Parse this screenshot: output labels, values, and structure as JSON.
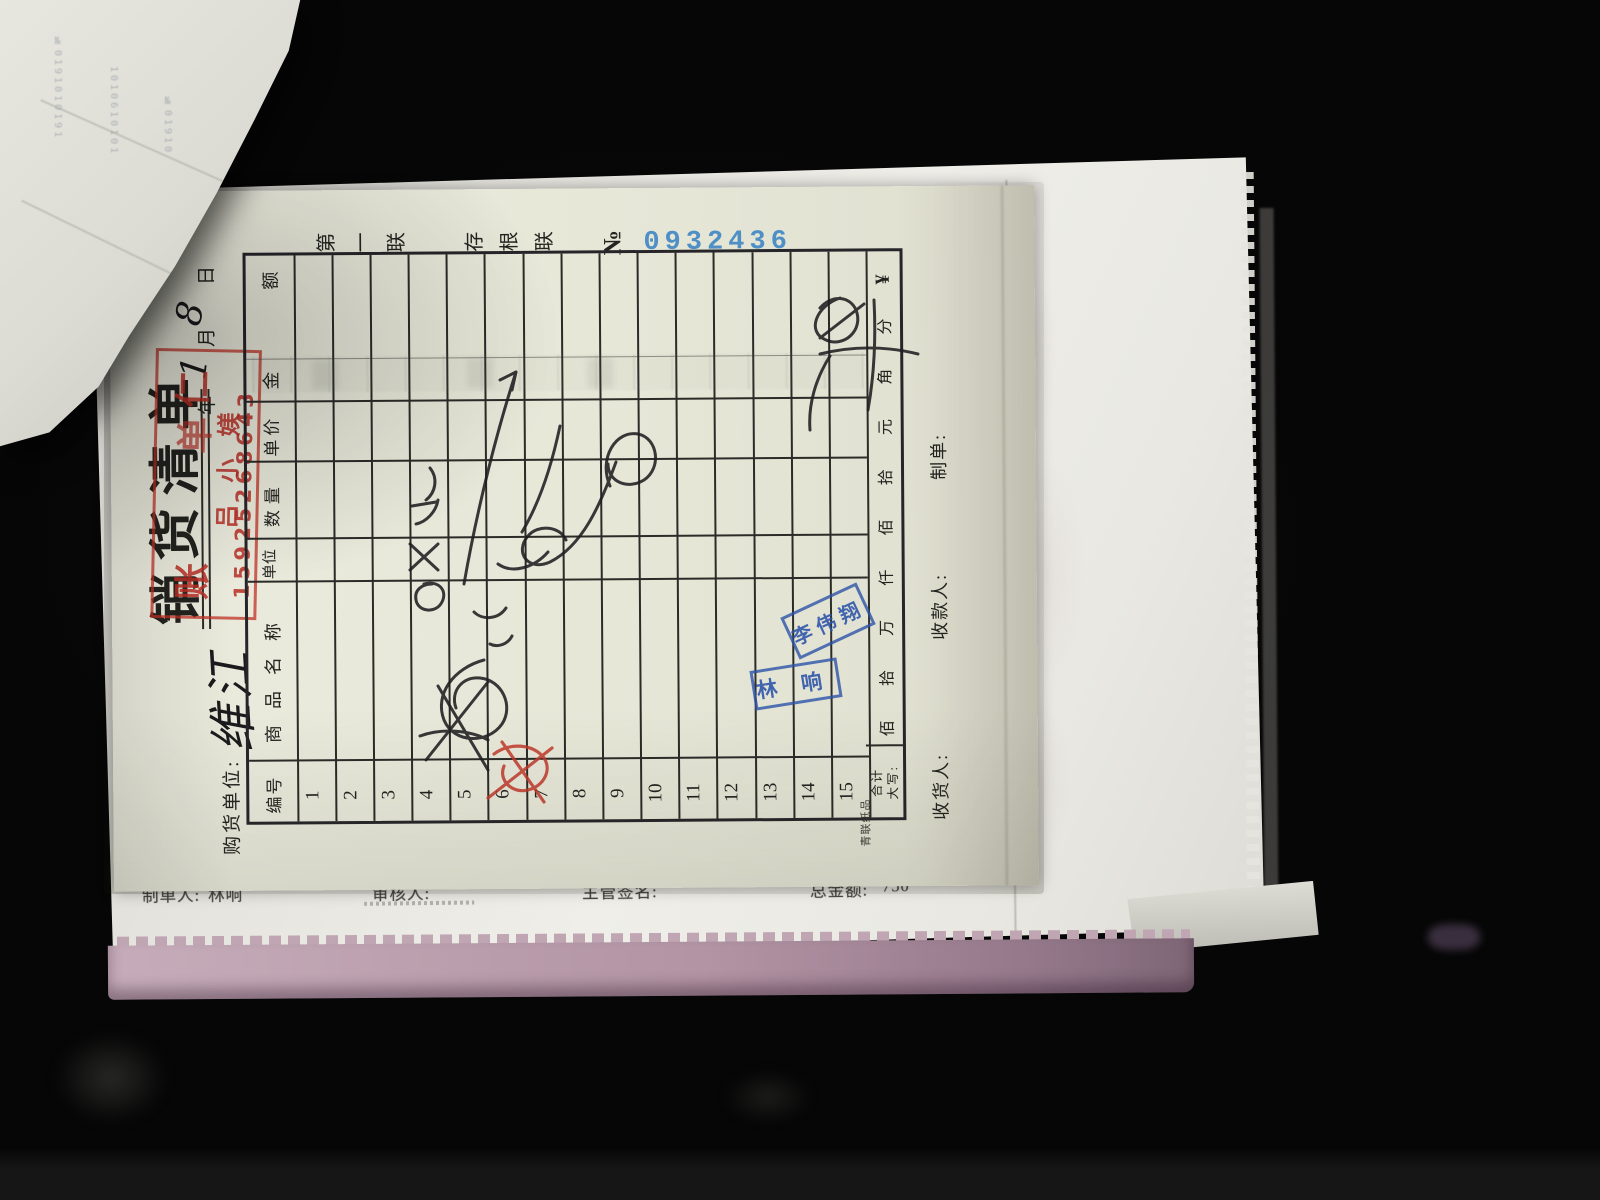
{
  "receipt": {
    "serial": {
      "copy": "第一联",
      "stub": "存根联",
      "no": "№",
      "number": "0932436"
    },
    "title": "销货清单",
    "buyer": {
      "label": "购货单位:",
      "value": "维江"
    },
    "date": {
      "year": "年",
      "month": "月",
      "day": "日",
      "month_value": "1",
      "day_value": "8"
    },
    "red_stamp": {
      "char1": "账",
      "char2": "单",
      "char3": "仁",
      "name": "吕小媄",
      "phone": "15925268643"
    },
    "table": {
      "headers": {
        "no": "编号",
        "name": "商品名称",
        "unit": "单位",
        "qty": "数量",
        "price": "单价",
        "amount_char1": "金",
        "amount_char2": "额"
      },
      "row_numbers": [
        "1",
        "2",
        "3",
        "4",
        "5",
        "6",
        "7",
        "8",
        "9",
        "10",
        "11",
        "12",
        "13",
        "14",
        "15"
      ]
    },
    "total": {
      "label1": "合计",
      "label2": "大写:",
      "units": [
        "佰",
        "拾",
        "万",
        "仟",
        "佰",
        "拾",
        "元",
        "角",
        "分"
      ],
      "currency": "¥"
    },
    "footer": {
      "receiver": "收货人:",
      "cashier": "收款人:",
      "maker": "制单:"
    },
    "printer_mark": "青联纸品"
  },
  "stamps": {
    "stamp1": "李伟翔",
    "stamp2": "林响"
  },
  "under_sheet": {
    "maker_label": "制单人:",
    "maker_name": "林响",
    "auditor_label": "审核人:",
    "supervisor_label": "主管签名:",
    "total_label": "总金额:",
    "total_value": "750"
  },
  "fold": {
    "bleed1": "№0191010191",
    "bleed2": "1010610101",
    "bleed3": "№01910"
  },
  "handwriting_notes": {
    "buyer": "维江",
    "month": "1",
    "day": "8",
    "item_scrawl": "虾仁",
    "qty_scrawl": "17×16",
    "amount_scrawl": "750",
    "total_scrawl": "750",
    "red_scrawl": "划掉"
  }
}
